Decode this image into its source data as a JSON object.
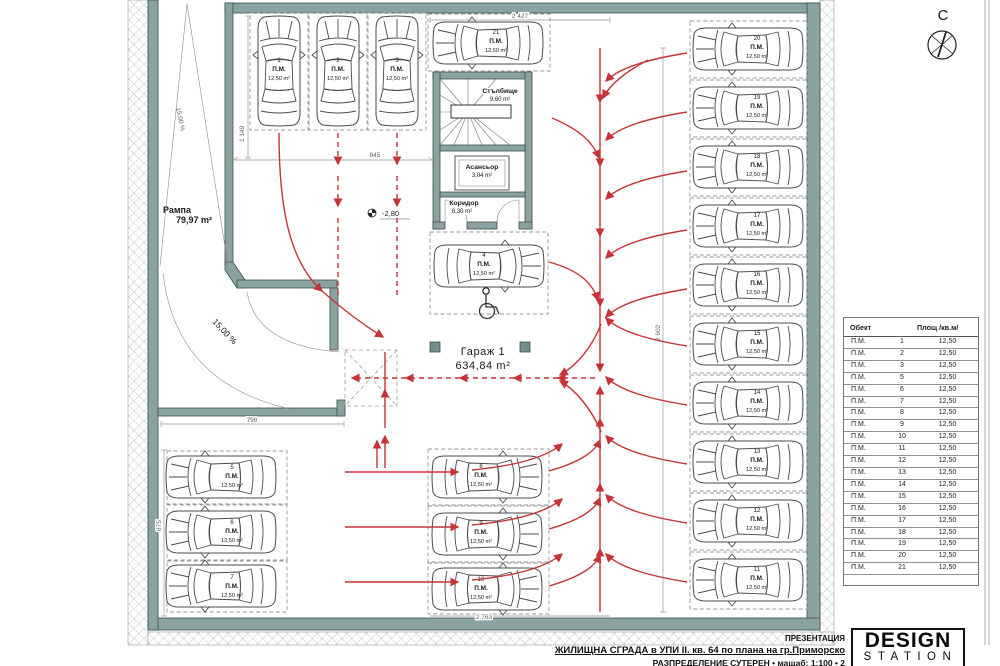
{
  "colors": {
    "flow_red": "#c53437",
    "wall_fill": "#8ba3a0",
    "hatch_grey": "#9aa6a3"
  },
  "compass": {
    "label": "С"
  },
  "ramp": {
    "name": "Рампа",
    "area": "79,97 m²",
    "slope_upper": "15,00 %",
    "slope_lower": "15,00 %"
  },
  "rooms": {
    "stairs": {
      "name": "Стълбище",
      "area": "9,60 m²"
    },
    "elevator": {
      "name": "Асансьор",
      "area": "3,04 m²"
    },
    "corridor": {
      "name": "Коридор",
      "area": "8,30 m²"
    },
    "garage": {
      "name": "Гараж 1",
      "area": "634,84 m²"
    }
  },
  "level_marker": "-2,80",
  "dimensions": {
    "top": "2 427",
    "left_upper": "1 149",
    "upper_inner": "845",
    "right_inner": "2 602",
    "ramp_bottom": "798",
    "left_lower": "875",
    "bottom": "2 763"
  },
  "spots": [
    {
      "num": "1",
      "unit": "П.М.",
      "area": "12,50 m²"
    },
    {
      "num": "2",
      "unit": "П.М.",
      "area": "12,50 m²"
    },
    {
      "num": "3",
      "unit": "П.М.",
      "area": "12,50 m²"
    },
    {
      "num": "4",
      "unit": "П.М.",
      "area": "12,50 m²"
    },
    {
      "num": "5",
      "unit": "П.М.",
      "area": "12,50 m²"
    },
    {
      "num": "6",
      "unit": "П.М.",
      "area": "12,50 m²"
    },
    {
      "num": "7",
      "unit": "П.М.",
      "area": "12,50 m²"
    },
    {
      "num": "8",
      "unit": "П.М.",
      "area": "12,50 m²"
    },
    {
      "num": "9",
      "unit": "П.М.",
      "area": "12,50 m²"
    },
    {
      "num": "10",
      "unit": "П.М.",
      "area": "12,50 m²"
    },
    {
      "num": "11",
      "unit": "П.М.",
      "area": "12,50 m²"
    },
    {
      "num": "12",
      "unit": "П.М.",
      "area": "12,50 m²"
    },
    {
      "num": "13",
      "unit": "П.М.",
      "area": "12,50 m²"
    },
    {
      "num": "14",
      "unit": "П.М.",
      "area": "12,50 m²"
    },
    {
      "num": "15",
      "unit": "П.М.",
      "area": "12,50 m²"
    },
    {
      "num": "16",
      "unit": "П.М.",
      "area": "12,50 m²"
    },
    {
      "num": "17",
      "unit": "П.М.",
      "area": "12,50 m²"
    },
    {
      "num": "18",
      "unit": "П.М.",
      "area": "12,50 m²"
    },
    {
      "num": "19",
      "unit": "П.М.",
      "area": "12,50 m²"
    },
    {
      "num": "20",
      "unit": "П.М.",
      "area": "12,50 m²"
    },
    {
      "num": "21",
      "unit": "П.М.",
      "area": "12,50 m²"
    }
  ],
  "table": {
    "headers": [
      "Обект",
      "Площ  /кв.м/"
    ],
    "rows": [
      [
        "П.М.",
        "1",
        "12,50"
      ],
      [
        "П.М.",
        "2",
        "12,50"
      ],
      [
        "П.М.",
        "3",
        "12,50"
      ],
      [
        "П.М.",
        "5",
        "12,50"
      ],
      [
        "П.М.",
        "6",
        "12,50"
      ],
      [
        "П.М.",
        "7",
        "12,50"
      ],
      [
        "П.М.",
        "8",
        "12,50"
      ],
      [
        "П.М.",
        "9",
        "12,50"
      ],
      [
        "П.М.",
        "10",
        "12,50"
      ],
      [
        "П.М.",
        "11",
        "12,50"
      ],
      [
        "П.М.",
        "12",
        "12,50"
      ],
      [
        "П.М.",
        "13",
        "12,50"
      ],
      [
        "П.М.",
        "14",
        "12,50"
      ],
      [
        "П.М.",
        "15",
        "12,50"
      ],
      [
        "П.М.",
        "16",
        "12,50"
      ],
      [
        "П.М.",
        "17",
        "12,50"
      ],
      [
        "П.М.",
        "18",
        "12,50"
      ],
      [
        "П.М.",
        "19",
        "12,50"
      ],
      [
        "П.М.",
        "20",
        "12,50"
      ],
      [
        "П.М.",
        "21",
        "12,50"
      ]
    ]
  },
  "title_block": {
    "line1": "ПРЕЗЕНТАЦИЯ",
    "line2": "ЖИЛИЩНА СГРАДА в УПИ II. кв. 64 по плана на гр.Приморско",
    "line3": "РАЗПРЕДЕЛЕНИЕ СУТЕРЕН • мащаб: 1:100 • 2"
  },
  "logo": {
    "line1": "DESIGN",
    "line2": "STATION"
  }
}
